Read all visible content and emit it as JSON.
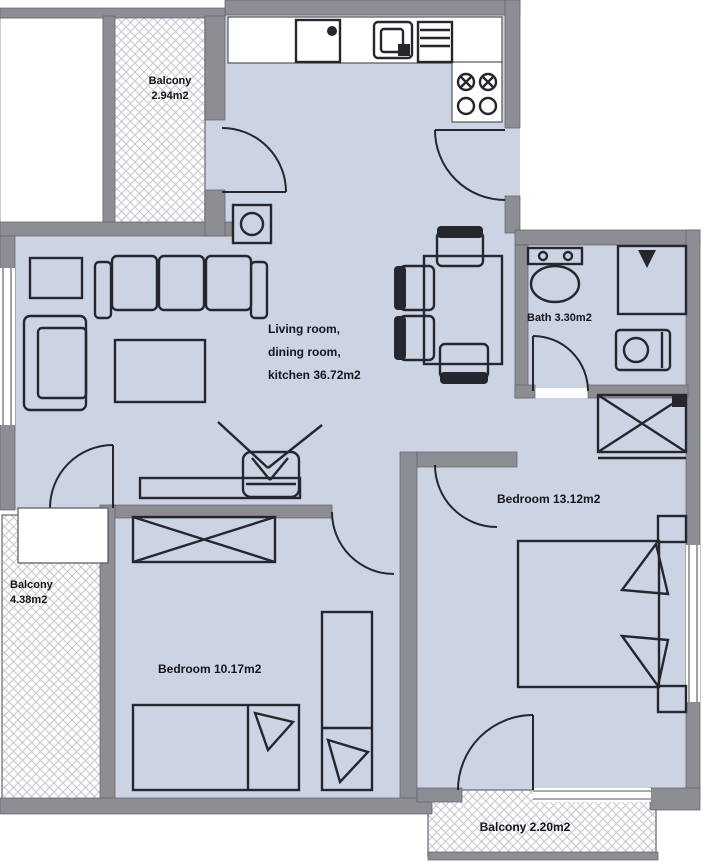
{
  "palette": {
    "room_fill": "#ccd3e2",
    "wall": "#8d8d94",
    "line": "#26262e",
    "hatch": "#c6c9d2",
    "label": "#15151b"
  },
  "plan": {
    "type": "apartment-floor-plan",
    "labels": {
      "balcony_top": {
        "name": "Balcony",
        "area": "2.94m2"
      },
      "living": {
        "line1": "Living room,",
        "line2": "dining room,",
        "line3": "kitchen 36.72m2"
      },
      "bath": {
        "text": "Bath 3.30m2"
      },
      "bedroom_right": {
        "text": "Bedroom 13.12m2"
      },
      "bedroom_bottom": {
        "text": "Bedroom 10.17m2"
      },
      "balcony_left": {
        "name": "Balcony",
        "area": "4.38m2"
      },
      "balcony_bottom": {
        "text": "Balcony 2.20m2"
      }
    },
    "rooms": [
      {
        "name": "Living room, dining room, kitchen",
        "area_m2": 36.72
      },
      {
        "name": "Bath",
        "area_m2": 3.3
      },
      {
        "name": "Bedroom (right)",
        "area_m2": 13.12
      },
      {
        "name": "Bedroom (bottom)",
        "area_m2": 10.17
      },
      {
        "name": "Balcony (top)",
        "area_m2": 2.94
      },
      {
        "name": "Balcony (left)",
        "area_m2": 4.38
      },
      {
        "name": "Balcony (bottom)",
        "area_m2": 2.2
      }
    ],
    "symbols": [
      "kitchen-counter",
      "kitchen-sink",
      "stove-burners",
      "sofa",
      "armchair",
      "coffee-table",
      "side-table",
      "dining-table",
      "dining-chair",
      "tv",
      "shelf",
      "wardrobe",
      "double-bed",
      "single-bed",
      "pillow",
      "nightstand",
      "toilet",
      "shower",
      "washing-machine",
      "door-swing",
      "window",
      "balcony-hatch"
    ]
  }
}
